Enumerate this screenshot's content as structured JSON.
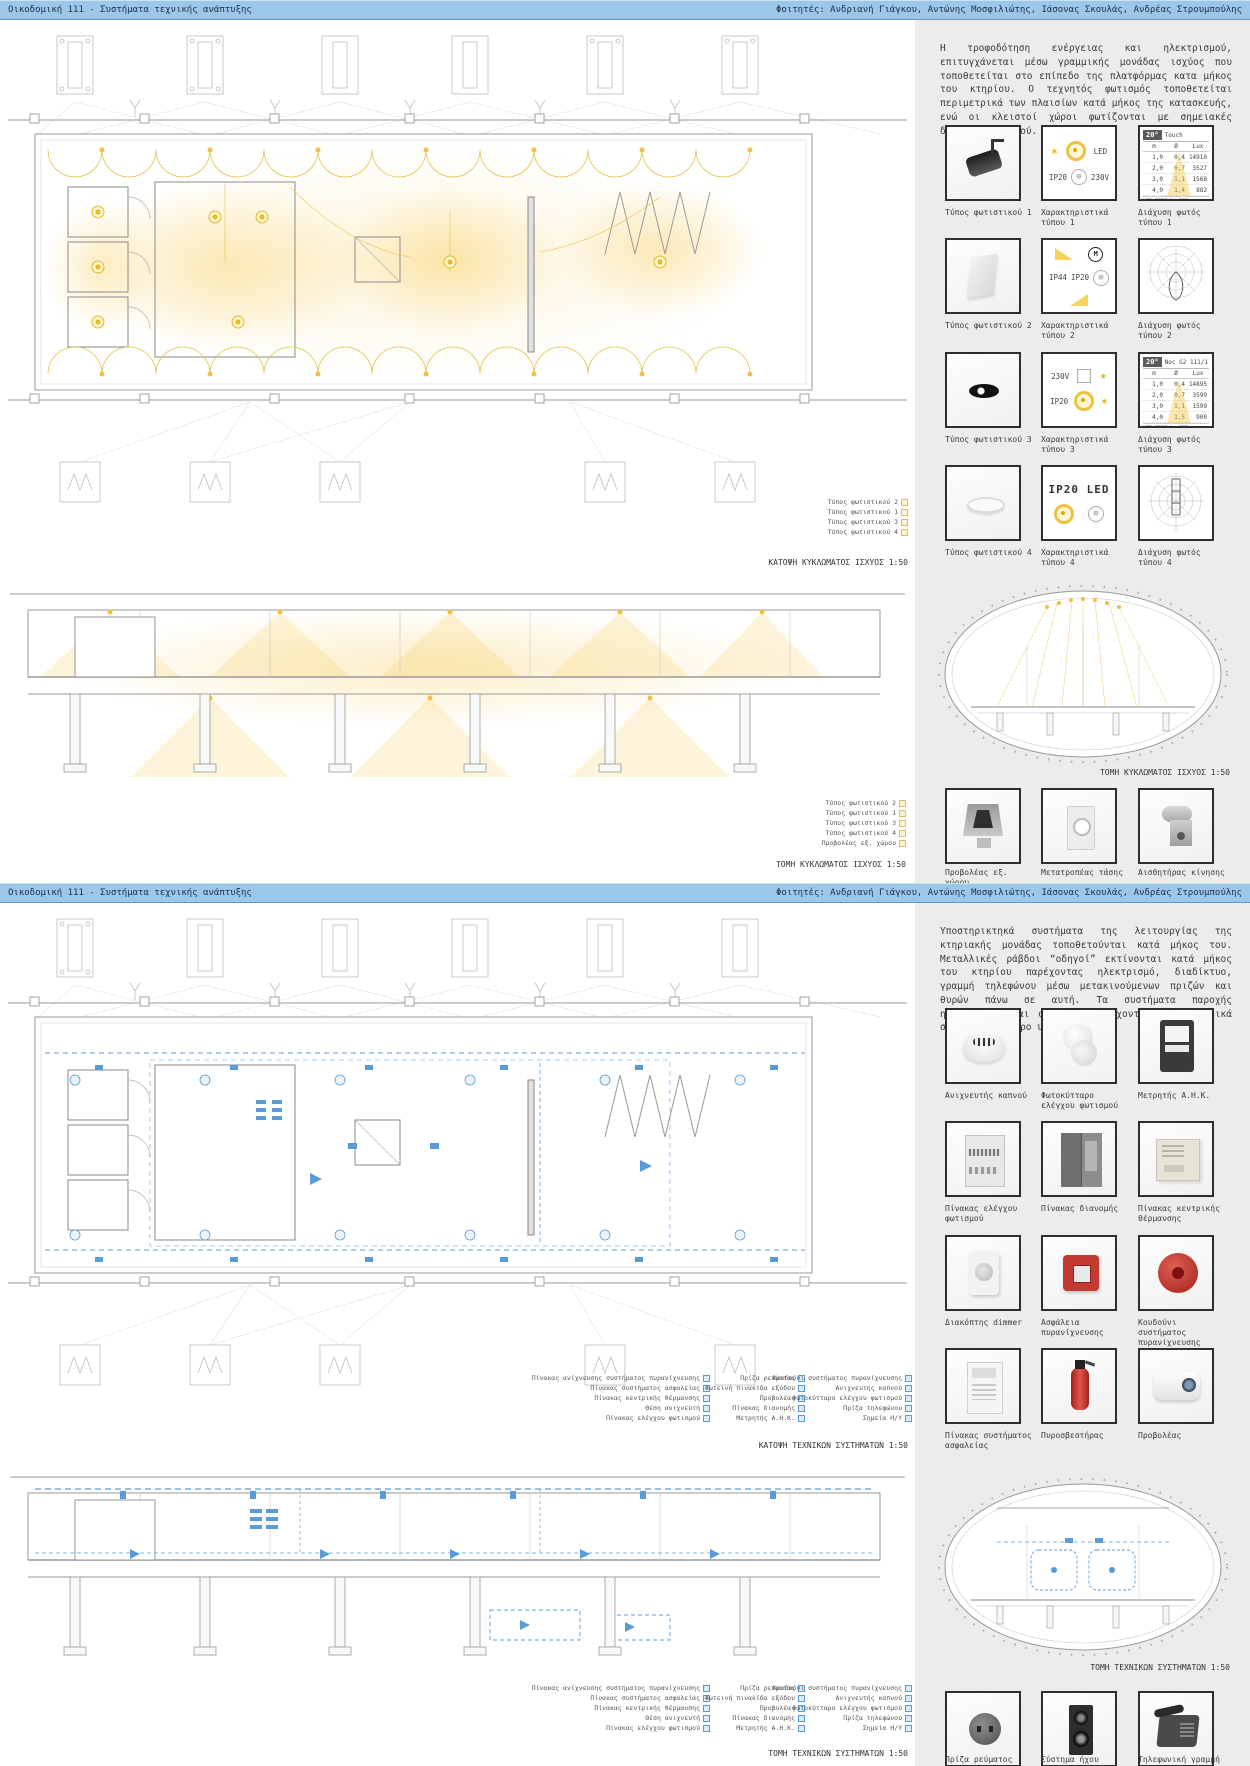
{
  "colors": {
    "accent_yellow": "#F0C040",
    "accent_blue": "#5B9BD5",
    "header_blue": "#9CC7E9",
    "sidebar_gray": "#ECECEC"
  },
  "boards": [
    {
      "header": {
        "title": "Οικοδομική 111 - Συστήματα τεχνικής ανάπτυξης",
        "students": "Φοιτητές: Ανδριανή Γιάγκου, Αντώνης Μοσφιλιώτης, Ιάσονας Σκουλάς, Ανδρέας Στρουμπούλης"
      },
      "paragraph": "Η τροφοδότηση ενέργειας και ηλεκτρισμού, επιτυγχάνεται μέσω γραμμικής μονάδας ισχύος που τοποθετείται στο επίπεδο της πλατφόρμας κατα μήκος του κτηρίου. Ο τεχνητός φωτισμός τοποθετείται περιμετρικά των πλαισίων κατά μήκος της κατασκευής, ενώ οι κλειστοί χώροι φωτίζονται με σημειακές διόδους φωτισμού.",
      "plan_caption": "ΚΑΤΟΨΗ ΚΥΚΛΩΜΑΤΟΣ ΙΣΧΥΟΣ 1:50",
      "section_caption": "ΤΟΜΗ ΚΥΚΛΩΜΑΤΟΣ ΙΣΧΥΟΣ 1:50",
      "plan_legend": [
        "Τύπος φωτιστικού 2",
        "Τύπος φωτιστικού 1",
        "Τύπος φωτιστικού 3",
        "Τύπος φωτιστικού 4"
      ],
      "section_legend": [
        "Τύπος φωτιστικού 2",
        "Τύπος φωτιστικού 1",
        "Τύπος φωτιστικού 3",
        "Τύπος φωτιστικού 4",
        "Προβολέας εξ. χώρου"
      ],
      "grid_labels": {
        "r1": [
          "Τύπος φωτιστικού 1",
          "Χαρακτηριστικά τύπου 1",
          "Διάχυση φωτός τύπου 1"
        ],
        "r2": [
          "Τύπος φωτιστικού 2",
          "Χαρακτηριστικά τύπου 2",
          "Διάχυση φωτός τύπου 2"
        ],
        "r3": [
          "Τύπος φωτιστικού 3",
          "Χαρακτηριστικά τύπου 3",
          "Διάχυση φωτός τύπου 3"
        ],
        "r4": [
          "Τύπος φωτιστικού 4",
          "Χαρακτηριστικά τύπου 4",
          "Διάχυση φωτός τύπου 4"
        ]
      },
      "char_icons": {
        "t1": [
          "LED",
          "IP20",
          "230V"
        ],
        "t2": [
          "IP44",
          "IP20"
        ],
        "t3": [
          "230V",
          "IP20"
        ],
        "t4": [
          "IP20 LED"
        ]
      },
      "diff1": {
        "deg": "20°",
        "name": "Touch",
        "cols": [
          "m",
          "Ø",
          "Lux"
        ],
        "rows": [
          [
            "1,0",
            "0,4",
            "14910"
          ],
          [
            "2,0",
            "0,7",
            "3527"
          ],
          [
            "3,0",
            "1,1",
            "1568"
          ],
          [
            "4,0",
            "1,4",
            "882"
          ]
        ],
        "footer": "LED 3000 lm 930"
      },
      "diff3": {
        "deg": "20°",
        "name": "Noc G2 111/1",
        "cols": [
          "m",
          "Ø",
          "Lux"
        ],
        "rows": [
          [
            "1,0",
            "0,4",
            "14895"
          ],
          [
            "2,0",
            "0,7",
            "3599"
          ],
          [
            "3,0",
            "1,1",
            "1599"
          ],
          [
            "4,0",
            "1,5",
            "900"
          ]
        ],
        "footer": "LED 3000 lm 930 (medium)"
      },
      "ellipse_caption": "ΤΟΜΗ ΚΥΚΛΩΜΑΤΟΣ ΙΣΧΥΟΣ 1:50",
      "bottom_row": [
        "Προβολέας εξ. χώρου",
        "Μετατροπέας τάσης",
        "Αισθητήρας κίνησης"
      ]
    },
    {
      "header": {
        "title": "Οικοδομική 111 - Συστήματα τεχνικής ανάπτυξης",
        "students": "Φοιτητές: Ανδριανή Γιάγκου, Αντώνης Μοσφιλιώτης, Ιάσονας Σκουλάς, Ανδρέας Στρουμπούλης"
      },
      "paragraph": "Υποστηρικτηκά συστήματα της λειτουργίας της κτηριακής μονάδας τοποθετούνται κατά μήκος του. Μεταλλικές ράβδοι “οδηγοί” εκτίνονται κατά μήκος του κτηρίου παρέχοντας ηλεκτρισμό, διαδίκτυο, γραμμή τηλεφώνου μέσω μετακινούμενων πριζών και θυρών πάνω σε αυτή. Τα συστήματα παροχής ηλεκτρισμού και φωτισμού ελέγχονται από κεντρικά σημεία στον χώρο υποδοχής.",
      "plan_caption": "ΚΑΤΟΨΗ ΤΕΧΝΙΚΩΝ ΣΥΣΤΗΜΑΤΩΝ 1:50",
      "section_caption": "ΤΟΜΗ ΤΕΧΝΙΚΩΝ ΣΥΣΤΗΜΑΤΩΝ 1:50",
      "legend_cols": {
        "c1": [
          "Πίνακας ανίχνευσης συστήματος πυρανίχνευσης",
          "Πίνακας συστήματος ασφαλείας",
          "Πίνακας κεντρικής θέρμανσης",
          "Θέση ανιχνευτή",
          "Πίνακας ελέγχου φωτισμού"
        ],
        "c2": [
          "Πρίζα ρεύματος",
          "Φωτεινή πινακίδα εξόδου",
          "Προβολέας",
          "Πίνακας διανομής",
          "Μετρητής Α.Η.Κ."
        ],
        "c3": [
          "Κουδούνι συστήματος πυρανίχνευσης",
          "Ανιχνευτής καπνού",
          "Φωτοκύτταρο ελέγχου φωτισμού",
          "Πρίζα τηλεφώνου",
          "Σημεία Η/Υ"
        ]
      },
      "grid_labels": {
        "r1": [
          "Ανιχνευτής καπνού",
          "Φωτοκύτταρο ελέγχου φωτισμού",
          "Μετρητής Α.Η.Κ."
        ],
        "r2": [
          "Πίνακας ελέγχου φωτισμού",
          "Πίνακας διανομής",
          "Πίνακας κεντρικής θέρμανσης"
        ],
        "r3": [
          "Διακόπτης dimmer",
          "Ασφάλεια πυρανίχνευσης",
          "Κουδούνι συστήματος πυρανίχνευσης"
        ],
        "r4": [
          "Πίνακας συστήματος ασφαλείας",
          "Πυροσβεστήρας",
          "Προβολέας"
        ]
      },
      "ellipse_caption": "ΤΟΜΗ ΤΕΧΝΙΚΩΝ ΣΥΣΤΗΜΑΤΩΝ 1:50",
      "bottom_row": [
        "Πρίζα ρεύματος",
        "Σύστημα ήχου",
        "Τηλεφωνική γραμμή"
      ]
    }
  ]
}
